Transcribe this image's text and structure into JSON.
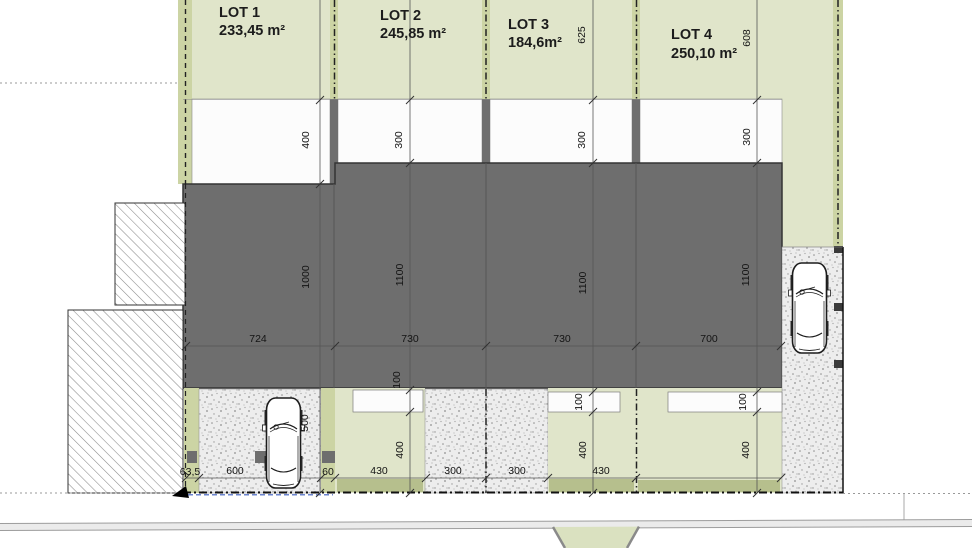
{
  "plan_title": "Site division plan",
  "lots": [
    {
      "name": "LOT 1",
      "area": "233,45 m²"
    },
    {
      "name": "LOT 2",
      "area": "245,85 m²"
    },
    {
      "name": "LOT 3",
      "area": "184,6m²"
    },
    {
      "name": "LOT 4",
      "area": "250,10 m²"
    }
  ],
  "dims": [
    "625",
    "608",
    "400",
    "300",
    "300",
    "300",
    "1000",
    "1100",
    "1100",
    "1100",
    "100",
    "100",
    "100",
    "400",
    "400",
    "400",
    "500",
    "724",
    "730",
    "730",
    "700",
    "63,5",
    "600",
    "60",
    "430",
    "300",
    "300",
    "430"
  ],
  "colors": {
    "lot_green": "#e0e5ca",
    "boundary_strip_green": "#ccd4a4",
    "hedge_green": "#b6bf8d",
    "building_gray": "#6e6e6e",
    "stipple_bg": "#ededed",
    "road_gray": "#ebebeb",
    "boundary_blue": "#3a5bbf"
  }
}
